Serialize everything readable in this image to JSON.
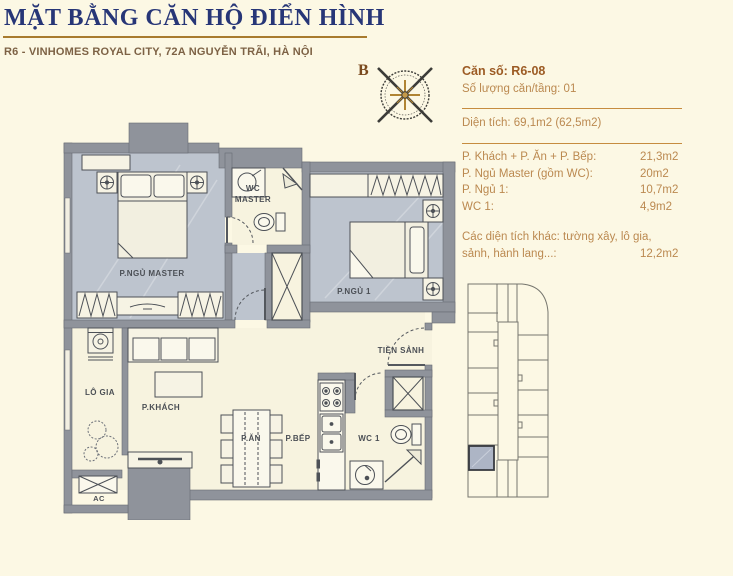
{
  "header": {
    "title": "MẶT BẰNG CĂN HỘ ĐIỂN HÌNH",
    "subtitle": "R6 - VINHOMES ROYAL CITY, 72A NGUYỄN TRÃI, HÀ NỘI"
  },
  "compass": {
    "north_label": "B"
  },
  "info_panel": {
    "unit_line": "Căn số: R6-08",
    "per_floor_line": "Số lượng căn/tầng: 01",
    "area_line": "Diện tích: 69,1m2 (62,5m2)",
    "rooms": [
      {
        "label": "P. Khách + P. Ăn + P. Bếp:",
        "value": "21,3m2"
      },
      {
        "label": "P. Ngủ Master (gồm WC):",
        "value": "20m2"
      },
      {
        "label": "P. Ngủ 1:",
        "value": "10,7m2"
      },
      {
        "label": "WC 1:",
        "value": "4,9m2"
      }
    ],
    "other": {
      "label_line1": "Các diện tích khác: tường xây, lô gia,",
      "label_line2": "sảnh, hành lang...:",
      "value": "12,2m2"
    }
  },
  "floor_plan": {
    "labels": {
      "master_bedroom": "P.NGỦ MASTER",
      "wc_master_line1": "WC",
      "wc_master_line2": "MASTER",
      "bedroom_1": "P.NGỦ 1",
      "hall": "TIỀN SẢNH",
      "loggia": "LÔ GIA",
      "living": "P.KHÁCH",
      "dining": "P.ĂN",
      "kitchen": "P.BẾP",
      "wc_1": "WC 1",
      "ac": "AC"
    }
  },
  "colors": {
    "background": "#FCF8E4",
    "title_navy": "#273677",
    "gold": "#A87B2E",
    "text_brown_bold": "#9C5B24",
    "text_tan": "#BB8950",
    "wall_gray": "#8F939B",
    "floor_blue": "#BDC4CE",
    "floor_cream": "#F7F3DF",
    "highlight_unit": "#ADB5C5"
  }
}
